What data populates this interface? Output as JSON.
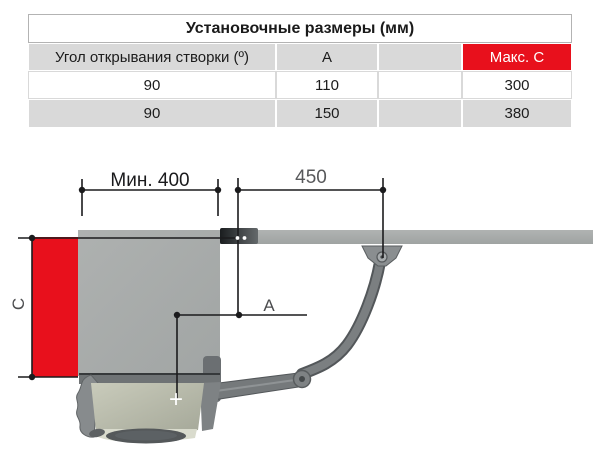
{
  "table": {
    "title": "Установочные размеры (мм)",
    "col_headers": [
      "Угол открывания створки (º)",
      "A",
      "",
      "Макс. C"
    ],
    "rows": [
      [
        "90",
        "110",
        "",
        "300"
      ],
      [
        "90",
        "150",
        "",
        "380"
      ]
    ]
  },
  "diagram": {
    "dim_min_400": "Мин. 400",
    "dim_450": "450",
    "dim_a_label": "A",
    "dim_c_label": "C",
    "plus_marker": "+",
    "colors": {
      "highlight_red": "#e8101c",
      "structure_gray": "#a9adac",
      "dimension_black": "#1b1b1d",
      "secondary_label_gray": "#58595b"
    }
  }
}
